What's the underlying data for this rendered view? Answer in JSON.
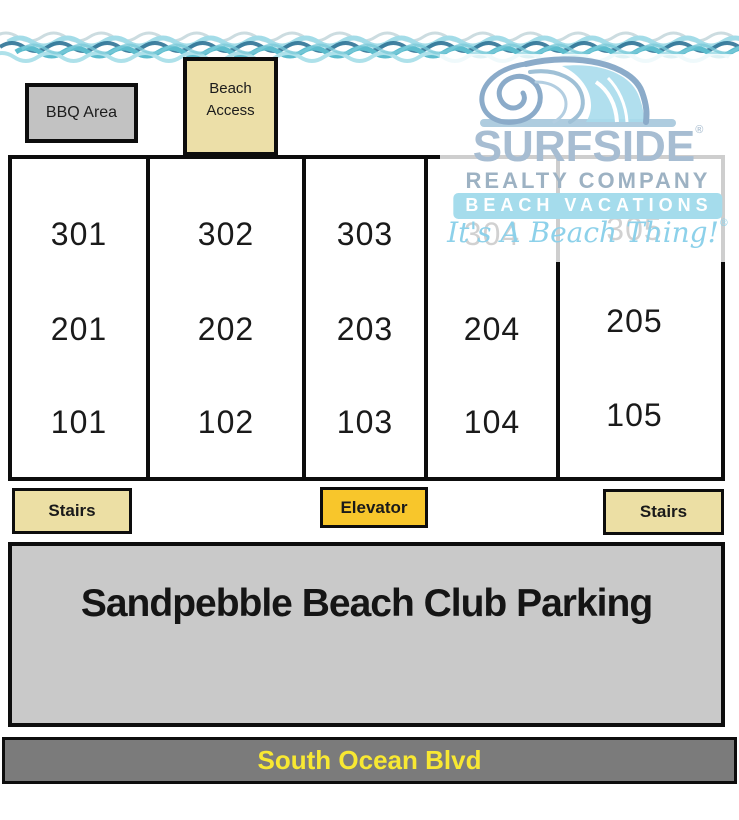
{
  "map": {
    "bbq_label": "BBQ Area",
    "beach_access_label": "Beach Access",
    "stairs_left_label": "Stairs",
    "elevator_label": "Elevator",
    "stairs_right_label": "Stairs",
    "parking_label": "Sandpebble Beach Club Parking",
    "street_label": "South Ocean Blvd"
  },
  "building": {
    "columns": [
      {
        "units": [
          "301",
          "201",
          "101"
        ]
      },
      {
        "units": [
          "302",
          "202",
          "102"
        ]
      },
      {
        "units": [
          "303",
          "203",
          "103"
        ]
      },
      {
        "units": [
          "304",
          "204",
          "104"
        ]
      },
      {
        "units": [
          "305",
          "205",
          "105"
        ]
      }
    ]
  },
  "logo": {
    "name": "SURFSIDE",
    "registered": "®",
    "line2": "REALTY COMPANY",
    "banner": "BEACH VACATIONS",
    "tagline": "It's A Beach Thing!"
  },
  "colors": {
    "tan_box": "#ecdfa6",
    "elevator_gold": "#f8c62b",
    "bbq_gray": "#c2c2c2",
    "parking_gray": "#c9c9c9",
    "road_gray": "#7b7b7b",
    "road_text_yellow": "#f8e832",
    "border_black": "#0d0d0d",
    "logo_blue": "#a7bdd2",
    "logo_banner_blue": "#a5dcec",
    "wave_dark": "#2f7396",
    "wave_teal": "#5cbccd",
    "wave_light": "#a3dce8"
  }
}
